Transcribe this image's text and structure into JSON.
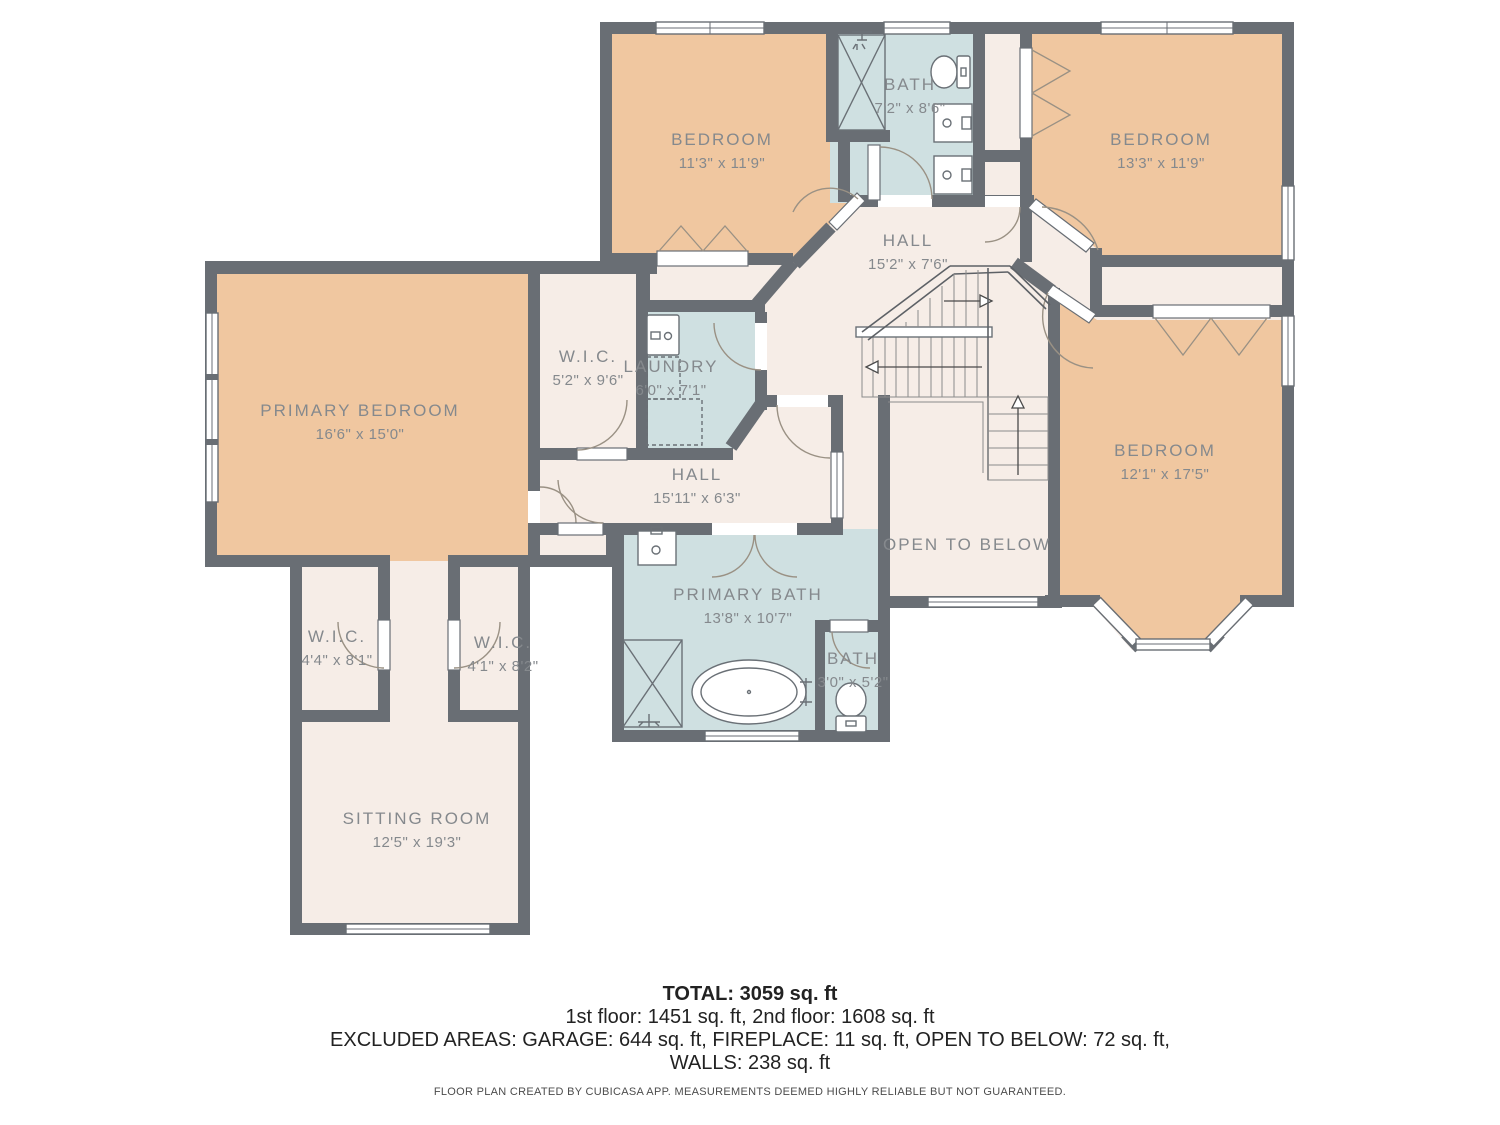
{
  "floorplan": {
    "colors": {
      "bedroom_fill": "#f0c7a0",
      "bath_fill": "#cfe0e1",
      "hall_fill": "#f6ede7",
      "wall": "#696e74",
      "label": "#85898d"
    },
    "rooms": [
      {
        "id": "bedroom-top-left",
        "name": "BEDROOM",
        "dims": "11'3\" x 11'9\"",
        "x": 722,
        "y": 145
      },
      {
        "id": "bath-top",
        "name": "BATH",
        "dims": "7'2\" x 8'6\"",
        "x": 910,
        "y": 90
      },
      {
        "id": "bedroom-top-right",
        "name": "BEDROOM",
        "dims": "13'3\" x 11'9\"",
        "x": 1161,
        "y": 145
      },
      {
        "id": "hall-upper",
        "name": "HALL",
        "dims": "15'2\" x 7'6\"",
        "x": 908,
        "y": 246
      },
      {
        "id": "primary-bedroom",
        "name": "PRIMARY BEDROOM",
        "dims": "16'6\" x 15'0\"",
        "x": 360,
        "y": 416
      },
      {
        "id": "wic-primary",
        "name": "W.I.C.",
        "dims": "5'2\" x 9'6\"",
        "x": 588,
        "y": 362
      },
      {
        "id": "laundry",
        "name": "LAUNDRY",
        "dims": "6'0\" x 7'1\"",
        "x": 671,
        "y": 372
      },
      {
        "id": "hall-lower",
        "name": "HALL",
        "dims": "15'11\" x 6'3\"",
        "x": 697,
        "y": 480
      },
      {
        "id": "bedroom-right",
        "name": "BEDROOM",
        "dims": "12'1\" x 17'5\"",
        "x": 1165,
        "y": 456
      },
      {
        "id": "open-to-below",
        "name": "OPEN TO BELOW",
        "dims": "",
        "x": 967,
        "y": 550
      },
      {
        "id": "primary-bath",
        "name": "PRIMARY BATH",
        "dims": "13'8\" x 10'7\"",
        "x": 748,
        "y": 600
      },
      {
        "id": "bath-small",
        "name": "BATH",
        "dims": "3'0\" x 5'2\"",
        "x": 853,
        "y": 664
      },
      {
        "id": "wic-left",
        "name": "W.I.C.",
        "dims": "4'4\" x 8'1\"",
        "x": 337,
        "y": 642
      },
      {
        "id": "wic-right",
        "name": "W.I.C.",
        "dims": "4'1\" x 8'2\"",
        "x": 503,
        "y": 648
      },
      {
        "id": "sitting-room",
        "name": "SITTING ROOM",
        "dims": "12'5\" x 19'3\"",
        "x": 417,
        "y": 824
      }
    ]
  },
  "summary": {
    "total": "TOTAL: 3059 sq. ft",
    "floors": "1st floor: 1451 sq. ft, 2nd floor: 1608 sq. ft",
    "excluded": "EXCLUDED AREAS: GARAGE: 644 sq. ft, FIREPLACE: 11 sq. ft, OPEN TO BELOW: 72 sq. ft,",
    "walls": "WALLS: 238 sq. ft",
    "disclaimer": "FLOOR PLAN CREATED BY CUBICASA APP. MEASUREMENTS DEEMED HIGHLY RELIABLE BUT NOT GUARANTEED."
  }
}
